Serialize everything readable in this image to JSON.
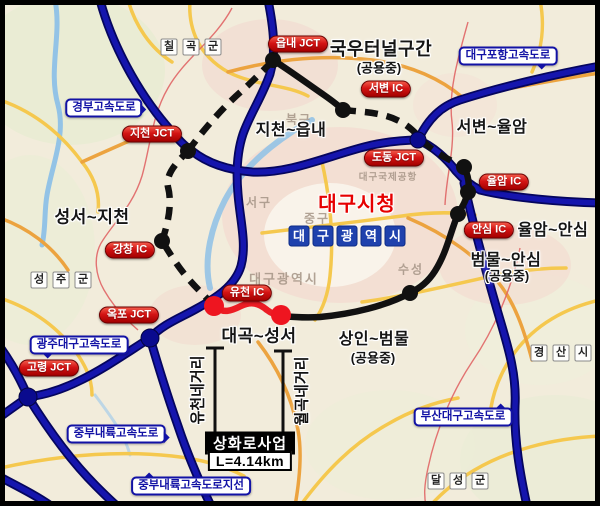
{
  "map": {
    "badges": {
      "eupnae_jct": "읍내 JCT",
      "jicheon_jct": "지천 JCT",
      "gangchang_ic": "강창 IC",
      "okpo_jct": "옥포 JCT",
      "goryeong_jct": "고령 JCT",
      "yucheon_ic": "유천 IC",
      "dodong_jct": "도동 JCT",
      "seobyeon_ic": "서변 IC",
      "yulam_ic": "율암 IC",
      "ansim_ic": "안심 IC"
    },
    "highways": {
      "gyeongbu": "경부고속도로",
      "daegu_pohang": "대구포항고속도로",
      "gwangju_daegu": "광주대구고속도로",
      "jungbu_naeryuk": "중부내륙고속도로",
      "jungbu_naeryuk_jiseon": "중부내륙고속도로지선",
      "busan_daegu": "부산대구고속도로"
    },
    "sections": {
      "jicheon_eupnae": "지천~읍내",
      "gukwoo_tunnel": "국우터널구간",
      "gukwoo_tunnel_status": "(공용중)",
      "seobyeon_yulam": "서변~율암",
      "yulam_ansim": "율암~안심",
      "beommul_ansim": "범물~안심",
      "beommul_ansim_status": "(공용중)",
      "sangin_beommul": "상인~범물",
      "sangin_beommul_status": "(공용중)",
      "daegok_seongseo": "대곡~성서",
      "seongseo_jicheon": "성서~지천"
    },
    "regions": {
      "chilgok": [
        "칠",
        "곡",
        "군"
      ],
      "seongju": [
        "성",
        "주",
        "군"
      ],
      "gyeongsan": [
        "경",
        "산",
        "시"
      ],
      "dalseong": [
        "달",
        "성",
        "군"
      ]
    },
    "city": {
      "daegu_city_hall": "대구시청",
      "daegu_metro_chars": [
        "대",
        "구",
        "광",
        "역",
        "시"
      ]
    },
    "faint_labels": {
      "bukgu": "북구",
      "seogu": "서구",
      "junggu": "중구",
      "suseong": "수성",
      "airport": "대구국제공항",
      "metro": "대구광역시"
    },
    "project": {
      "name": "상화로사업",
      "length": "L=4.14km",
      "yucheon_intersection": "유천네거리",
      "wolgok_intersection": "월곡네거리"
    },
    "colors": {
      "highway_blue": "#1111a8",
      "project_red": "#ec1c24",
      "ring_black": "#111111",
      "badge_red": "#c40000",
      "label_blue": "#1212a5"
    }
  }
}
